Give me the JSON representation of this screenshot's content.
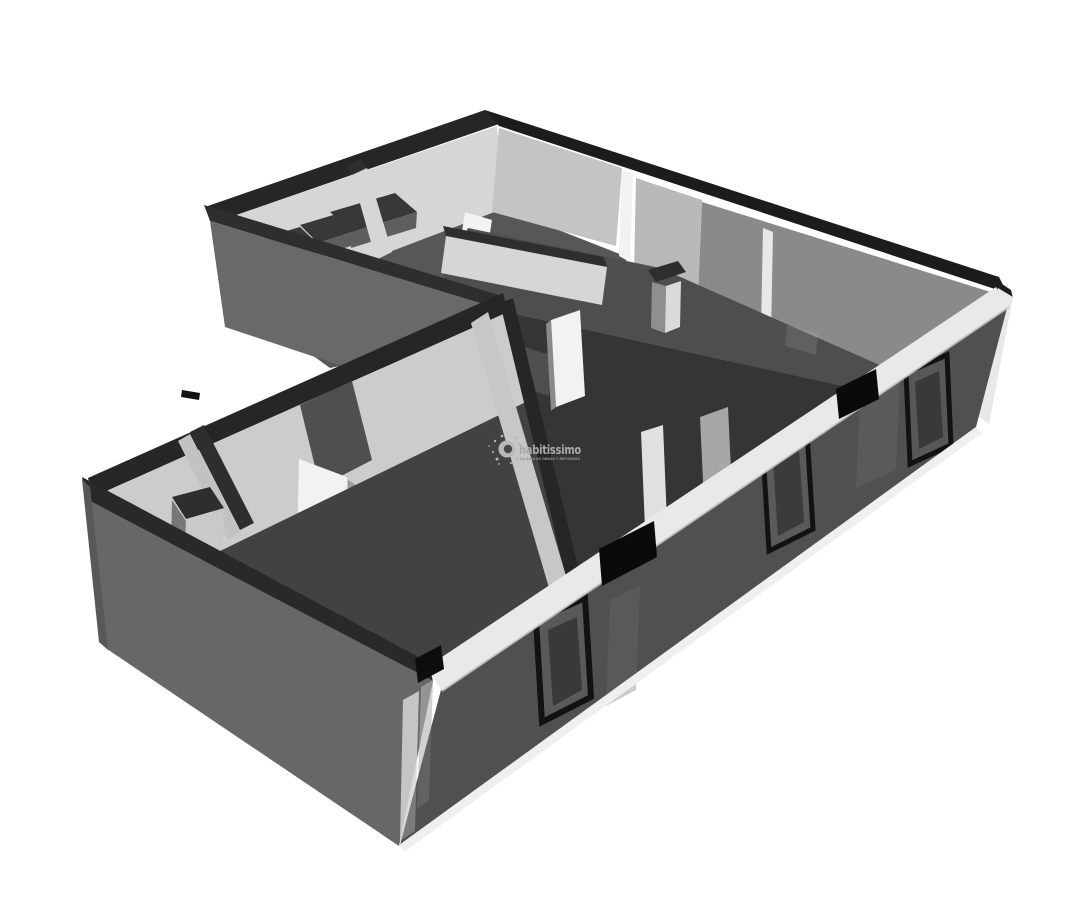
{
  "figure": {
    "kind": "3D floor plan rendering",
    "style": "grayscale axonometric cutaway (dollhouse view) of an apartment with open doors and glass front facade",
    "background_color": "#ffffff"
  },
  "watermark": {
    "brand": "habitissimo",
    "tagline": "LA GUÍA DE OBRAS Y REFORMAS",
    "icon": "paint-splatter-icon",
    "brand_color": "#a9a9a9",
    "tagline_color": "#8f8f8f"
  },
  "palette": {
    "background": "#ffffff",
    "wall_cap": "#262626",
    "exterior_wall": "#696969",
    "interior_wall_bright": "#d6d6d6",
    "interior_wall_medium": "#8a8a8a",
    "floor_light": "#575757",
    "floor_main": "#4e4e4e",
    "floor_shadow": "#353535",
    "facade_band": "#e9e9e9",
    "glass_tint": "#101010",
    "door_frame": "#141414",
    "door_leaf": "#f2f2f2",
    "accent_black": "#0a0a0a"
  }
}
